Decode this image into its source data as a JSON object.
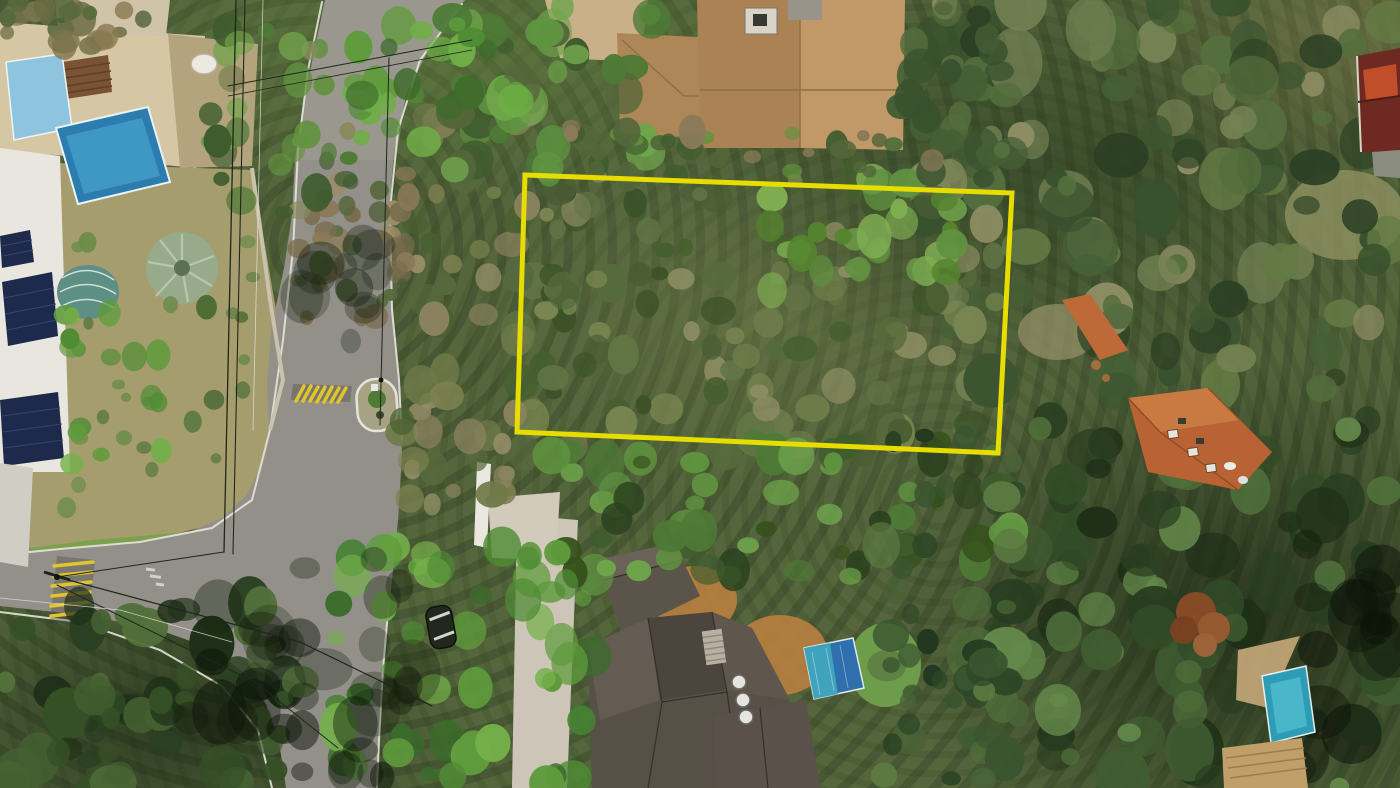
{
  "meta": {
    "type": "aerial-drone-photo",
    "description": "Aerial top-down drone photograph of a wooded residential neighborhood; a yellow rectangle outline annotates a forested land plot for sale between a curving street with houses and pools on the left and dense forest on the right."
  },
  "colors": {
    "plot_outline": "#e7dd00",
    "asphalt": "#93908a",
    "curb_white": "#e6e4da",
    "terrace_stone": "#d6c7a4",
    "pool_light_blue": "#8ec4de",
    "pool_deep_blue": "#2d7cb0",
    "pool_tarp_blue": "#2f6fae",
    "pool_turquoise": "#2f9cb5",
    "solar_panel_blue": "#1d2a4c",
    "awning_teal": "#5d8f85",
    "roof_tan": "#b8905e",
    "roof_dark_gray": "#575047",
    "roof_terracotta": "#b96334",
    "roof_slats_tan": "#c09f68",
    "building_maroon": "#6e2a22",
    "dirt_orange": "#b97f3f",
    "dirt_path_tan": "#c9b089",
    "lawn_dry": "#a59d6e",
    "lawn_green": "#7da04e",
    "speed_bump_yellow": "#e0c52e",
    "forest_base_green": "#55663d"
  },
  "plot": {
    "points": "525,175 1012,193 998,453 517,432",
    "stroke_width": 5
  },
  "scene": {
    "width": 1400,
    "height": 788,
    "forest_zones": [
      {
        "name": "top-right-forest",
        "x": 925,
        "y": 0,
        "w": 475,
        "h": 435,
        "n": 120,
        "rmin": 9,
        "rmax": 28,
        "seed": 11,
        "palette": [
          "#2c4124",
          "#38512e",
          "#465f35",
          "#556e3d",
          "#647b45",
          "#748253",
          "#8d8d63",
          "#3c5530"
        ]
      },
      {
        "name": "right-lower-forest",
        "x": 965,
        "y": 420,
        "w": 435,
        "h": 368,
        "n": 100,
        "rmin": 9,
        "rmax": 28,
        "seed": 12,
        "palette": [
          "#1e2f18",
          "#283d20",
          "#334c28",
          "#405c31",
          "#4f6f3a",
          "#63884a",
          "#2a4022"
        ]
      },
      {
        "name": "plot-interior",
        "x": 518,
        "y": 172,
        "w": 490,
        "h": 285,
        "n": 110,
        "rmin": 7,
        "rmax": 20,
        "seed": 13,
        "palette": [
          "#4a5d34",
          "#566b3c",
          "#627545",
          "#6d7c4a",
          "#7a8652",
          "#8c8c62",
          "#465f2f",
          "#3c5228"
        ]
      },
      {
        "name": "plot-bright-cluster",
        "x": 770,
        "y": 178,
        "w": 200,
        "h": 120,
        "n": 28,
        "rmin": 8,
        "rmax": 18,
        "seed": 14,
        "palette": [
          "#6fa04a",
          "#7fae52",
          "#609140",
          "#55842f"
        ]
      },
      {
        "name": "west-of-plot",
        "x": 400,
        "y": 95,
        "w": 130,
        "h": 420,
        "n": 55,
        "rmin": 7,
        "rmax": 18,
        "seed": 15,
        "palette": [
          "#6f7a48",
          "#7d8050",
          "#8b835f",
          "#97906a",
          "#57693c",
          "#49602f"
        ]
      },
      {
        "name": "top-strip",
        "x": 445,
        "y": 0,
        "w": 210,
        "h": 175,
        "n": 45,
        "rmin": 8,
        "rmax": 20,
        "seed": 16,
        "palette": [
          "#4e7a36",
          "#5f9440",
          "#6fa44b",
          "#3f5c2e",
          "#54663a"
        ]
      },
      {
        "name": "road-canopy-top",
        "x": 350,
        "y": 15,
        "w": 180,
        "h": 140,
        "n": 30,
        "rmin": 8,
        "rmax": 18,
        "seed": 17,
        "palette": [
          "#5f9b3c",
          "#6fae46",
          "#4f8c34",
          "#3f6b2c"
        ]
      },
      {
        "name": "below-plot",
        "x": 540,
        "y": 438,
        "w": 480,
        "h": 145,
        "n": 60,
        "rmin": 8,
        "rmax": 20,
        "seed": 18,
        "palette": [
          "#3f5c2e",
          "#4e7a36",
          "#5f9440",
          "#2c421f",
          "#6fa44b",
          "#35511b"
        ]
      },
      {
        "name": "bottom-left-corner",
        "x": 0,
        "y": 598,
        "w": 305,
        "h": 190,
        "n": 60,
        "rmin": 9,
        "rmax": 24,
        "seed": 19,
        "palette": [
          "#1f3019",
          "#2a4022",
          "#365026",
          "#446031",
          "#52703a"
        ]
      },
      {
        "name": "big-bright-tree",
        "x": 330,
        "y": 542,
        "w": 270,
        "h": 246,
        "n": 50,
        "rmin": 8,
        "rmax": 20,
        "seed": 20,
        "palette": [
          "#4f8c34",
          "#5f9b3c",
          "#74b04a",
          "#468232",
          "#3a6b2b"
        ]
      },
      {
        "name": "road-overhang-bare-tree",
        "x": 292,
        "y": 168,
        "w": 135,
        "h": 165,
        "n": 38,
        "rmin": 5,
        "rmax": 13,
        "seed": 21,
        "palette": [
          "#8a7a58",
          "#9b8d68",
          "#7a6c4e",
          "#57693c",
          "#4a5c34"
        ]
      },
      {
        "name": "topleft-corner-trees",
        "x": 0,
        "y": 0,
        "w": 150,
        "h": 52,
        "n": 22,
        "rmin": 7,
        "rmax": 16,
        "seed": 22,
        "palette": [
          "#6b6b42",
          "#7a744c",
          "#57693c",
          "#8a7a52",
          "#4a5c34"
        ]
      },
      {
        "name": "left-garden-trees",
        "x": 198,
        "y": 18,
        "w": 155,
        "h": 195,
        "n": 34,
        "rmin": 7,
        "rmax": 16,
        "seed": 23,
        "palette": [
          "#4f7a35",
          "#62923f",
          "#74a44c",
          "#3f5c2e",
          "#8a8a5e"
        ]
      },
      {
        "name": "lawn-bushes",
        "x": 60,
        "y": 180,
        "w": 200,
        "h": 330,
        "n": 24,
        "rmin": 5,
        "rmax": 11,
        "seed": 24,
        "palette": [
          "#4e6b35",
          "#5d7a42",
          "#6d8c4a"
        ]
      },
      {
        "name": "left-palms",
        "x": 62,
        "y": 300,
        "w": 108,
        "h": 170,
        "n": 16,
        "rmin": 7,
        "rmax": 14,
        "seed": 25,
        "palette": [
          "#4f8c34",
          "#5f9b3c",
          "#74b04a"
        ]
      },
      {
        "name": "house-right-trees",
        "x": 892,
        "y": 0,
        "w": 120,
        "h": 180,
        "n": 30,
        "rmin": 8,
        "rmax": 18,
        "seed": 26,
        "palette": [
          "#2c4124",
          "#38512e",
          "#465f35",
          "#556e3d"
        ]
      },
      {
        "name": "house-bottom-band",
        "x": 560,
        "y": 126,
        "w": 420,
        "h": 56,
        "n": 28,
        "rmin": 6,
        "rmax": 14,
        "seed": 27,
        "palette": [
          "#3f5c2e",
          "#54663a",
          "#62923f",
          "#8a7a58"
        ]
      },
      {
        "name": "center-bottom-forest",
        "x": 872,
        "y": 428,
        "w": 148,
        "h": 360,
        "n": 42,
        "rmin": 8,
        "rmax": 20,
        "seed": 28,
        "palette": [
          "#223820",
          "#2d4627",
          "#3a5530",
          "#4a6338",
          "#5d7a42"
        ]
      },
      {
        "name": "shadow-junction",
        "x": 140,
        "y": 558,
        "w": 280,
        "h": 175,
        "n": 24,
        "rmin": 12,
        "rmax": 30,
        "seed": 31,
        "palette": [
          "rgba(16,26,11,0.42)",
          "rgba(22,34,14,0.38)",
          "rgba(10,18,7,0.5)"
        ]
      },
      {
        "name": "shadow-midroad",
        "x": 288,
        "y": 238,
        "w": 112,
        "h": 132,
        "n": 12,
        "rmin": 10,
        "rmax": 24,
        "seed": 32,
        "palette": [
          "rgba(16,26,11,0.4)",
          "rgba(22,34,14,0.35)"
        ]
      },
      {
        "name": "shadow-bottomroad",
        "x": 268,
        "y": 688,
        "w": 125,
        "h": 100,
        "n": 10,
        "rmin": 10,
        "rmax": 24,
        "seed": 33,
        "palette": [
          "rgba(16,26,11,0.42)",
          "rgba(10,18,7,0.5)"
        ]
      },
      {
        "name": "shadow-farright",
        "x": 1292,
        "y": 540,
        "w": 108,
        "h": 248,
        "n": 16,
        "rmin": 14,
        "rmax": 34,
        "seed": 34,
        "palette": [
          "rgba(8,14,6,0.5)",
          "rgba(12,20,9,0.45)"
        ]
      }
    ]
  }
}
